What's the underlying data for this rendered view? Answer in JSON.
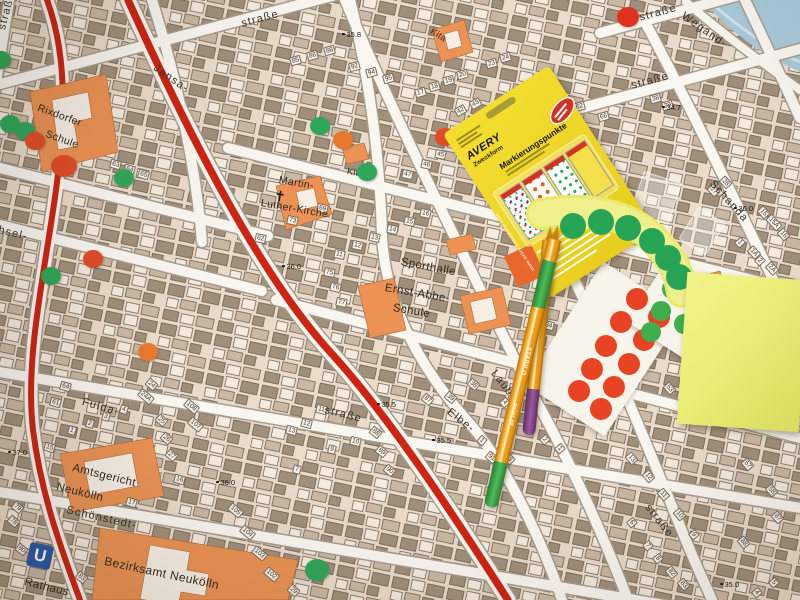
{
  "palette": {
    "map_bg": "#ecdfcf",
    "building_dark": "#9c8b77",
    "building_light": "#f5ecdf",
    "public_building_orange": "#eb9254",
    "street_fill": "#faf7f1",
    "main_road_red": "#cd2413",
    "water_blue": "#a9cbdc",
    "dot_green": "#2fa75a",
    "dot_orange": "#e87a2b",
    "dot_red": "#e14c28",
    "postit_yellow": "#ecef75",
    "package_yellow": "#efd828",
    "pen_orange": "#f0a01c",
    "pen_cap_purple": "#8d4e8f",
    "pen_cap_green": "#3da24a"
  },
  "map": {
    "ubahn_label": "U",
    "church_symbol": "✝",
    "street_labels": [
      {
        "text": "straße",
        "style": "left:240px;top:18px;transform:rotate(-15deg)"
      },
      {
        "text": "Jansa-",
        "style": "left:158px;top:62px;transform:rotate(35deg)"
      },
      {
        "text": "straße",
        "style": "left:-4px;top:28px;transform:rotate(-75deg)"
      },
      {
        "text": "hsel-",
        "style": "left:0px;top:224px;transform:rotate(14deg)"
      },
      {
        "text": "Fulda-",
        "style": "left:84px;top:396px;transform:rotate(16deg)"
      },
      {
        "text": "straße",
        "style": "left:326px;top:404px;transform:rotate(14deg)"
      },
      {
        "text": "Elbe-",
        "style": "left:452px;top:406px;transform:rotate(38deg)"
      },
      {
        "text": "Laube-",
        "style": "left:498px;top:368px;transform:rotate(52deg)"
      },
      {
        "text": "straße",
        "style": "left:652px;top:502px;transform:rotate(52deg)"
      },
      {
        "text": "straße",
        "style": "left:630px;top:80px;transform:rotate(-15deg)"
      },
      {
        "text": "straße",
        "style": "left:638px;top:12px;transform:rotate(-15deg)"
      },
      {
        "text": "Wegand-",
        "style": "left:686px;top:10px;transform:rotate(35deg)"
      },
      {
        "text": "Schanda",
        "style": "left:716px;top:178px;transform:rotate(48deg)"
      },
      {
        "text": "Schönstedt-",
        "style": "left:68px;top:504px;transform:rotate(13deg)"
      }
    ],
    "place_labels": [
      {
        "text": "Rixdorfer",
        "style": "left:40px;top:102px;transform:rotate(20deg);font-size:10.5px"
      },
      {
        "text": "Schule",
        "style": "left:48px;top:128px;transform:rotate(20deg);font-size:10.5px"
      },
      {
        "text": "Martin-",
        "style": "left:280px;top:174px;transform:rotate(10deg);font-size:10.5px"
      },
      {
        "text": "Luther-Kirche",
        "style": "left:262px;top:197px;transform:rotate(10deg);font-size:10.5px"
      },
      {
        "text": "Kita",
        "style": "left:348px;top:166px;transform:rotate(10deg);font-size:9px"
      },
      {
        "text": "Kita",
        "style": "left:434px;top:26px;transform:rotate(32deg);font-size:9px"
      },
      {
        "text": "Sporthalle",
        "style": "left:402px;top:256px;transform:rotate(11deg)"
      },
      {
        "text": "Ernst-Abbe-",
        "style": "left:386px;top:282px;transform:rotate(10deg)"
      },
      {
        "text": "Schule",
        "style": "left:394px;top:302px;transform:rotate(10deg)"
      },
      {
        "text": "Amtsgericht",
        "style": "left:74px;top:462px;transform:rotate(14deg)"
      },
      {
        "text": "Neukölln",
        "style": "left:58px;top:481px;transform:rotate(14deg)"
      },
      {
        "text": "Bezirksamt Neukölln",
        "style": "left:106px;top:554px;transform:rotate(12deg);font-size:12px"
      },
      {
        "text": "Rathaus",
        "style": "left:26px;top:576px;transform:rotate(14deg)"
      }
    ],
    "elevations": [
      {
        "text": "37.0",
        "style": "left:8px;top:448px"
      },
      {
        "text": "36.0",
        "style": "left:282px;top:262px"
      },
      {
        "text": "36.0",
        "style": "left:216px;top:478px"
      },
      {
        "text": "36.0",
        "style": "left:734px;top:204px"
      },
      {
        "text": "35.8",
        "style": "left:342px;top:30px"
      },
      {
        "text": "35.5",
        "style": "left:377px;top:400px"
      },
      {
        "text": "35.5",
        "style": "left:432px;top:436px"
      },
      {
        "text": "35.5",
        "style": "left:528px;top:365px"
      },
      {
        "text": "35.0",
        "style": "left:720px;top:580px"
      },
      {
        "text": "34.7",
        "style": "left:662px;top:103px"
      }
    ],
    "house_numbers": [
      {
        "text": "85",
        "style": "left:290px;top:56px;transform:rotate(-15deg)"
      },
      {
        "text": "86",
        "style": "left:307px;top:51px;transform:rotate(-15deg)"
      },
      {
        "text": "88",
        "style": "left:324px;top:46px;transform:rotate(-15deg)"
      },
      {
        "text": "92",
        "style": "left:349px;top:62px;transform:rotate(-15deg)"
      },
      {
        "text": "94",
        "style": "left:366px;top:68px;transform:rotate(-15deg)"
      },
      {
        "text": "95",
        "style": "left:383px;top:74px;transform:rotate(-15deg)"
      },
      {
        "text": "17",
        "style": "left:415px;top:88px;transform:rotate(-15deg)"
      },
      {
        "text": "18",
        "style": "left:429px;top:82px;transform:rotate(-15deg)"
      },
      {
        "text": "19",
        "style": "left:443px;top:76px;transform:rotate(-15deg)"
      },
      {
        "text": "20",
        "style": "left:457px;top:70px;transform:rotate(-15deg)"
      },
      {
        "text": "23",
        "style": "left:486px;top:59px;transform:rotate(-15deg)"
      },
      {
        "text": "24",
        "style": "left:500px;top:53px;transform:rotate(-15deg)"
      },
      {
        "text": "60",
        "style": "left:558px;top:96px;transform:rotate(-15deg)"
      },
      {
        "text": "62",
        "style": "left:574px;top:102px;transform:rotate(-15deg)"
      },
      {
        "text": "66",
        "style": "left:598px;top:112px;transform:rotate(-15deg)"
      },
      {
        "text": "63",
        "style": "left:110px;top:160px;transform:rotate(16deg)"
      },
      {
        "text": "64",
        "style": "left:124px;top:165px;transform:rotate(16deg)"
      },
      {
        "text": "65",
        "style": "left:138px;top:170px;transform:rotate(16deg)"
      },
      {
        "text": "42",
        "style": "left:455px;top:106px;transform:rotate(-30deg)"
      },
      {
        "text": "43",
        "style": "left:470px;top:99px;transform:rotate(-30deg)"
      },
      {
        "text": "21",
        "style": "left:501px;top:130px;transform:rotate(-30deg)"
      },
      {
        "text": "73",
        "style": "left:287px;top:216px;transform:rotate(12deg)"
      },
      {
        "text": "62",
        "style": "left:255px;top:234px;transform:rotate(12deg)"
      },
      {
        "text": "69",
        "style": "left:317px;top:204px;transform:rotate(12deg)"
      },
      {
        "text": "11",
        "style": "left:334px;top:250px;transform:rotate(12deg)"
      },
      {
        "text": "12",
        "style": "left:352px;top:241px;transform:rotate(12deg)"
      },
      {
        "text": "13",
        "style": "left:369px;top:233px;transform:rotate(12deg)"
      },
      {
        "text": "14",
        "style": "left:387px;top:225px;transform:rotate(12deg)"
      },
      {
        "text": "15",
        "style": "left:404px;top:217px;transform:rotate(12deg)"
      },
      {
        "text": "16",
        "style": "left:420px;top:209px;transform:rotate(12deg)"
      },
      {
        "text": "45",
        "style": "left:435px;top:150px;transform:rotate(12deg)"
      },
      {
        "text": "46",
        "style": "left:421px;top:160px;transform:rotate(12deg)"
      },
      {
        "text": "47",
        "style": "left:402px;top:170px;transform:rotate(12deg)"
      },
      {
        "text": "75",
        "style": "left:324px;top:268px;transform:rotate(12deg)"
      },
      {
        "text": "76",
        "style": "left:330px;top:283px;transform:rotate(12deg)"
      },
      {
        "text": "77",
        "style": "left:336px;top:298px;transform:rotate(12deg)"
      },
      {
        "text": "61",
        "style": "left:50px;top:398px;transform:rotate(16deg)"
      },
      {
        "text": "64",
        "style": "left:60px;top:382px;transform:rotate(16deg)"
      },
      {
        "text": "1",
        "style": "left:68px;top:426px;transform:rotate(16deg)"
      },
      {
        "text": "2",
        "style": "left:86px;top:419px;transform:rotate(16deg)"
      },
      {
        "text": "3",
        "style": "left:102px;top:412px;transform:rotate(16deg)"
      },
      {
        "text": "4",
        "style": "left:120px;top:405px;transform:rotate(16deg)"
      },
      {
        "text": "24",
        "style": "left:146px;top:380px;transform:rotate(40deg)"
      },
      {
        "text": "24A",
        "style": "left:138px;top:392px;transform:rotate(40deg)"
      },
      {
        "text": "25",
        "style": "left:156px;top:416px;transform:rotate(40deg)"
      },
      {
        "text": "26",
        "style": "left:161px;top:434px;transform:rotate(40deg)"
      },
      {
        "text": "27",
        "style": "left:166px;top:451px;transform:rotate(40deg)"
      },
      {
        "text": "108",
        "style": "left:184px;top:402px;transform:rotate(40deg)"
      },
      {
        "text": "107",
        "style": "left:188px;top:420px;transform:rotate(40deg)"
      },
      {
        "text": "15",
        "style": "left:44px;top:443px;transform:rotate(16deg)"
      },
      {
        "text": "16",
        "style": "left:174px;top:475px;transform:rotate(16deg)"
      },
      {
        "text": "17",
        "style": "left:126px;top:498px;transform:rotate(16deg)"
      },
      {
        "text": "78",
        "style": "left:8px;top:517px;transform:rotate(40deg)"
      },
      {
        "text": "79",
        "style": "left:12px;top:503px;transform:rotate(40deg)"
      },
      {
        "text": "80",
        "style": "left:16px;top:545px;transform:rotate(40deg)"
      },
      {
        "text": "83",
        "style": "left:76px;top:573px;transform:rotate(40deg)"
      },
      {
        "text": "105",
        "style": "left:228px;top:506px;transform:rotate(40deg)"
      },
      {
        "text": "104",
        "style": "left:240px;top:528px;transform:rotate(40deg)"
      },
      {
        "text": "103",
        "style": "left:252px;top:549px;transform:rotate(40deg)"
      },
      {
        "text": "102",
        "style": "left:264px;top:570px;transform:rotate(40deg)"
      },
      {
        "text": "29",
        "style": "left:288px;top:586px;transform:rotate(40deg)"
      },
      {
        "text": "11",
        "style": "left:316px;top:405px;transform:rotate(14deg)"
      },
      {
        "text": "12",
        "style": "left:301px;top:419px;transform:rotate(14deg)"
      },
      {
        "text": "13",
        "style": "left:286px;top:426px;transform:rotate(14deg)"
      },
      {
        "text": "10",
        "style": "left:350px;top:437px;transform:rotate(14deg)"
      },
      {
        "text": "9",
        "style": "left:328px;top:445px;transform:rotate(14deg)"
      },
      {
        "text": "7",
        "style": "left:293px;top:465px;transform:rotate(14deg)"
      },
      {
        "text": "88",
        "style": "left:370px;top:428px;transform:rotate(40deg)"
      },
      {
        "text": "89",
        "style": "left:376px;top:447px;transform:rotate(40deg)"
      },
      {
        "text": "90",
        "style": "left:384px;top:466px;transform:rotate(40deg)"
      },
      {
        "text": "38",
        "style": "left:468px;top:380px;transform:rotate(40deg)"
      },
      {
        "text": "39",
        "style": "left:445px;top:393px;transform:rotate(40deg)"
      },
      {
        "text": "87",
        "style": "left:422px;top:395px;transform:rotate(40deg)"
      },
      {
        "text": "1",
        "style": "left:478px;top:436px;transform:rotate(40deg)"
      },
      {
        "text": "91",
        "style": "left:486px;top:453px;transform:rotate(40deg)"
      },
      {
        "text": "2",
        "style": "left:541px;top:435px;transform:rotate(48deg)"
      },
      {
        "text": "1",
        "style": "left:556px;top:444px;transform:rotate(48deg)"
      },
      {
        "text": "4",
        "style": "left:501px;top:398px;transform:rotate(48deg)"
      },
      {
        "text": "3",
        "style": "left:506px;top:455px;transform:rotate(48deg)"
      },
      {
        "text": "34",
        "style": "left:543px;top:321px;transform:rotate(14deg)"
      },
      {
        "text": "122",
        "style": "left:605px;top:266px;transform:rotate(14deg)"
      },
      {
        "text": "53",
        "style": "left:664px;top:384px;transform:rotate(48deg)"
      },
      {
        "text": "54",
        "style": "left:688px;top:400px;transform:rotate(48deg)"
      },
      {
        "text": "13",
        "style": "left:626px;top:454px;transform:rotate(50deg)"
      },
      {
        "text": "12",
        "style": "left:643px;top:472px;transform:rotate(50deg)"
      },
      {
        "text": "11",
        "style": "left:658px;top:490px;transform:rotate(50deg)"
      },
      {
        "text": "10",
        "style": "left:674px;top:510px;transform:rotate(50deg)"
      },
      {
        "text": "9",
        "style": "left:690px;top:530px;transform:rotate(50deg)"
      },
      {
        "text": "6",
        "style": "left:628px;top:518px;transform:rotate(50deg)"
      },
      {
        "text": "7",
        "style": "left:644px;top:541px;transform:rotate(50deg)"
      },
      {
        "text": "8",
        "style": "left:654px;top:554px;transform:rotate(50deg)"
      },
      {
        "text": "82",
        "style": "left:666px;top:568px;transform:rotate(50deg)"
      },
      {
        "text": "83",
        "style": "left:678px;top:580px;transform:rotate(50deg)"
      },
      {
        "text": "88",
        "style": "left:738px;top:538px;transform:rotate(50deg)"
      },
      {
        "text": "87",
        "style": "left:772px;top:513px;transform:rotate(50deg)"
      },
      {
        "text": "57",
        "style": "left:742px;top:460px;transform:rotate(50deg)"
      },
      {
        "text": "58",
        "style": "left:766px;top:486px;transform:rotate(50deg)"
      },
      {
        "text": "4",
        "style": "left:753px;top:588px;transform:rotate(50deg)"
      },
      {
        "text": "5",
        "style": "left:770px;top:578px;transform:rotate(50deg)"
      },
      {
        "text": "15",
        "style": "left:758px;top:208px;transform:rotate(48deg)"
      },
      {
        "text": "15A",
        "style": "left:766px;top:218px;transform:rotate(48deg)"
      },
      {
        "text": "16",
        "style": "left:778px;top:230px;transform:rotate(48deg)"
      },
      {
        "text": "1",
        "style": "left:736px;top:238px;transform:rotate(48deg)"
      },
      {
        "text": "1A",
        "style": "left:748px;top:248px;transform:rotate(48deg)"
      },
      {
        "text": "2",
        "style": "left:756px;top:256px;transform:rotate(48deg)"
      },
      {
        "text": "2A",
        "style": "left:766px;top:264px;transform:rotate(48deg)"
      },
      {
        "text": "27",
        "style": "left:708px;top:186px;transform:rotate(48deg)"
      },
      {
        "text": "28",
        "style": "left:720px;top:178px;transform:rotate(48deg)"
      },
      {
        "text": "38",
        "style": "left:650px;top:94px;transform:rotate(-15deg)"
      },
      {
        "text": "39",
        "style": "left:662px;top:101px;transform:rotate(-15deg)"
      }
    ]
  },
  "map_stickers": [
    {
      "cls": "g",
      "style": "left:-9px;top:51px;width:20px;height:18px"
    },
    {
      "cls": "g",
      "style": "left:0px;top:115px;width:20px;height:18px"
    },
    {
      "cls": "g",
      "style": "left:15px;top:122px;width:20px;height:18px"
    },
    {
      "cls": "ro",
      "style": "left:25px;top:132px;width:20px;height:18px"
    },
    {
      "cls": "ro",
      "style": "left:51px;top:155px;width:26px;height:22px"
    },
    {
      "cls": "g",
      "style": "left:114px;top:169px;width:20px;height:18px"
    },
    {
      "cls": "g",
      "style": "left:310px;top:117px;width:20px;height:18px"
    },
    {
      "cls": "o",
      "style": "left:333px;top:131px;width:20px;height:18px"
    },
    {
      "cls": "g",
      "style": "left:357px;top:163px;width:20px;height:18px"
    },
    {
      "cls": "ro",
      "style": "left:435px;top:128px;width:20px;height:18px"
    },
    {
      "cls": "ro",
      "style": "left:83px;top:250px;width:20px;height:18px"
    },
    {
      "cls": "g",
      "style": "left:41px;top:267px;width:20px;height:18px"
    },
    {
      "cls": "o",
      "style": "left:138px;top:343px;width:20px;height:18px"
    },
    {
      "cls": "r",
      "style": "left:617px;top:7px;width:22px;height:20px"
    },
    {
      "cls": "g",
      "style": "left:305px;top:559px;width:24px;height:22px"
    }
  ],
  "sheets": {
    "strip_dots": [
      {
        "cls": "sg",
        "style": "left:560px;top:213px;width:26px;height:26px"
      },
      {
        "cls": "sg",
        "style": "left:588px;top:209px;width:26px;height:26px"
      },
      {
        "cls": "sg",
        "style": "left:615px;top:215px;width:26px;height:26px"
      },
      {
        "cls": "sg",
        "style": "left:639px;top:228px;width:26px;height:26px"
      },
      {
        "cls": "sg",
        "style": "left:655px;top:245px;width:26px;height:26px"
      },
      {
        "cls": "sg",
        "style": "left:666px;top:264px;width:26px;height:26px"
      }
    ],
    "red_sheet_dots": [
      {
        "cls": "sr",
        "style": "left:626px;top:288px;width:22px;height:22px"
      },
      {
        "cls": "sr",
        "style": "left:648px;top:306px;width:22px;height:22px"
      },
      {
        "cls": "sr",
        "style": "left:610px;top:311px;width:22px;height:22px"
      },
      {
        "cls": "sr",
        "style": "left:633px;top:329px;width:22px;height:22px"
      },
      {
        "cls": "sr",
        "style": "left:595px;top:335px;width:22px;height:22px"
      },
      {
        "cls": "sr",
        "style": "left:618px;top:353px;width:22px;height:22px"
      },
      {
        "cls": "sr",
        "style": "left:581px;top:358px;width:22px;height:22px"
      },
      {
        "cls": "sr",
        "style": "left:603px;top:376px;width:22px;height:22px"
      },
      {
        "cls": "sr",
        "style": "left:568px;top:380px;width:22px;height:22px"
      },
      {
        "cls": "sr",
        "style": "left:590px;top:398px;width:22px;height:22px"
      }
    ],
    "green_sheet_dots": [
      {
        "cls": "sgs",
        "style": "left:662px;top:279px;width:20px;height:20px"
      },
      {
        "cls": "sgs",
        "style": "left:685px;top:292px;width:20px;height:20px"
      },
      {
        "cls": "sgs",
        "style": "left:651px;top:301px;width:20px;height:20px"
      },
      {
        "cls": "sgs",
        "style": "left:674px;top:314px;width:20px;height:20px"
      },
      {
        "cls": "sgs",
        "style": "left:641px;top:322px;width:20px;height:20px"
      }
    ]
  },
  "package": {
    "brand_top": "AVERY",
    "brand_bottom": "Zweckform",
    "title": "Markierungspunkte",
    "website": "www.avery-zweckform.com",
    "sample_sheets": [
      "multicolor dots",
      "orange dots",
      "green dots",
      "yellow blank"
    ],
    "badge_color": "#d6311f"
  },
  "pens": {
    "a": {
      "brand": "STABILO",
      "model": "point 88",
      "cap_color": "#3da24a"
    },
    "b": {
      "brand": "STABILO",
      "model": "point 88",
      "cap_color": "#8d4e8f"
    }
  }
}
